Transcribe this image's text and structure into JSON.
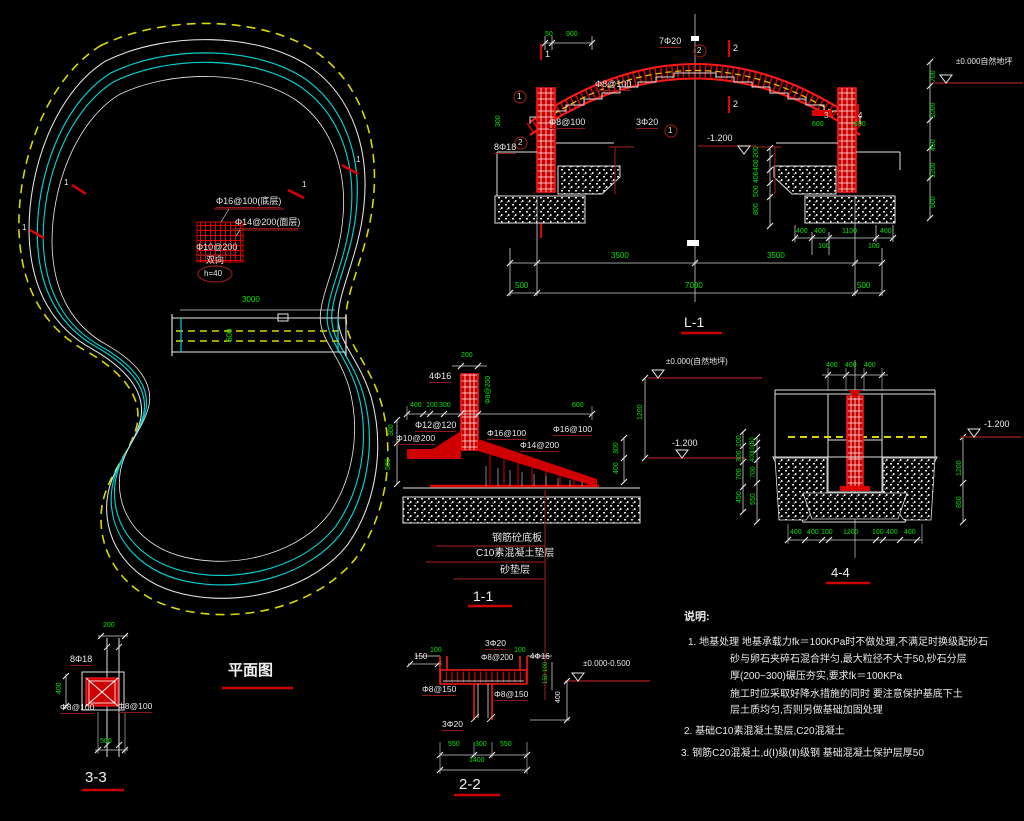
{
  "plan": {
    "title": "平面图"
  },
  "sections": {
    "l1": {
      "title": "L-1"
    },
    "s11": {
      "title": "1-1"
    },
    "s22": {
      "title": "2-2"
    },
    "s33": {
      "title": "3-3"
    },
    "s44": {
      "title": "4-4"
    }
  },
  "notes": {
    "title": "说明:",
    "lines": [
      "1. 地基处理 地基承载力fk＝100KPa时不做处理,不满足时换级配砂石",
      "砂与卵石夹碎石混合拌匀,最大粒径不大于50,砂石分层",
      "厚(200~300)碾压夯实,要求fk＝100KPa",
      "施工时应采取好降水措施的同时 要注意保护基底下土",
      "层土质均匀,否则另做基础加固处理",
      "2. 基础C10素混凝土垫层,C20混凝土",
      "3. 钢筋C20混凝土,d(Ⅰ)级(Ⅱ)级钢 基础混凝土保护层厚50"
    ]
  },
  "colors": {
    "w": "#e8e8e8",
    "g": "#00e400",
    "r": "#ff2a2a",
    "m": "#8b1a1a",
    "y": "#d8d800",
    "c": "#00d2d2"
  },
  "annotations": [
    {
      "n": "plan-rebar-bottom-label",
      "t": "Φ16@100(底层)",
      "x": 216,
      "y": 197,
      "c": "w",
      "s": 9,
      "u": 1
    },
    {
      "n": "plan-rebar-top-label",
      "t": "Φ14@200(面层)",
      "x": 235,
      "y": 218,
      "c": "w",
      "s": 9,
      "u": 1
    },
    {
      "n": "plan-rebar-dist-label",
      "t": "Φ10@200",
      "x": 196,
      "y": 243,
      "c": "w",
      "s": 9
    },
    {
      "n": "plan-both-ways-label",
      "t": "双向",
      "x": 206,
      "y": 256,
      "c": "w",
      "s": 9
    },
    {
      "n": "plan-thickness-label",
      "t": "h=40",
      "x": 204,
      "y": 270,
      "c": "w",
      "s": 8
    },
    {
      "n": "plan-dim",
      "t": "3000",
      "x": 242,
      "y": 296,
      "c": "g",
      "s": 8
    },
    {
      "n": "plan-dim",
      "t": "600",
      "x": 226,
      "y": 342,
      "c": "g",
      "s": 8,
      "r90": 1
    },
    {
      "n": "section-mark",
      "t": "1",
      "x": 356,
      "y": 156,
      "c": "w",
      "s": 8
    },
    {
      "n": "section-mark",
      "t": "1",
      "x": 302,
      "y": 181,
      "c": "w",
      "s": 8
    },
    {
      "n": "section-mark",
      "t": "1",
      "x": 64,
      "y": 179,
      "c": "w",
      "s": 8
    },
    {
      "n": "section-mark",
      "t": "1",
      "x": 22,
      "y": 224,
      "c": "w",
      "s": 8
    },
    {
      "n": "dim",
      "t": "50",
      "x": 545,
      "y": 31,
      "c": "g",
      "s": 7
    },
    {
      "n": "dim",
      "t": "900",
      "x": 566,
      "y": 31,
      "c": "g",
      "s": 7
    },
    {
      "n": "rebar-label",
      "t": "7Φ20",
      "x": 659,
      "y": 37,
      "c": "w",
      "s": 9,
      "u": 1
    },
    {
      "n": "bubble-no",
      "t": "2",
      "x": 697,
      "y": 47,
      "c": "w",
      "s": 8
    },
    {
      "n": "bubble-no",
      "t": "1",
      "x": 517,
      "y": 93,
      "c": "w",
      "s": 8
    },
    {
      "n": "bubble-no",
      "t": "2",
      "x": 518,
      "y": 139,
      "c": "w",
      "s": 8
    },
    {
      "n": "bubble-no",
      "t": "1",
      "x": 668,
      "y": 127,
      "c": "w",
      "s": 8
    },
    {
      "n": "rebar-label",
      "t": "Φ8@100",
      "x": 595,
      "y": 80,
      "c": "w",
      "s": 9,
      "u": 1
    },
    {
      "n": "rebar-label",
      "t": "3Φ20",
      "x": 636,
      "y": 118,
      "c": "w",
      "s": 9,
      "u": 1
    },
    {
      "n": "rebar-label",
      "t": "Φ8@100",
      "x": 549,
      "y": 118,
      "c": "w",
      "s": 9,
      "u": 1
    },
    {
      "n": "rebar-label",
      "t": "8Φ18",
      "x": 494,
      "y": 143,
      "c": "w",
      "s": 9,
      "u": 1
    },
    {
      "n": "dim",
      "t": "300",
      "x": 495,
      "y": 127,
      "c": "g",
      "s": 7,
      "r90": 1
    },
    {
      "n": "cut-label",
      "t": "2",
      "x": 733,
      "y": 44,
      "c": "w",
      "s": 9
    },
    {
      "n": "cut-label",
      "t": "2",
      "x": 733,
      "y": 100,
      "c": "w",
      "s": 9
    },
    {
      "n": "cut-label",
      "t": "1",
      "x": 545,
      "y": 50,
      "c": "w",
      "s": 9
    },
    {
      "n": "level-label",
      "t": "-1.200",
      "x": 707,
      "y": 134,
      "c": "w",
      "s": 9
    },
    {
      "n": "dim",
      "t": "200",
      "x": 753,
      "y": 158,
      "c": "g",
      "s": 7,
      "r90": 1
    },
    {
      "n": "dim",
      "t": "400",
      "x": 753,
      "y": 171,
      "c": "g",
      "s": 7,
      "r90": 1
    },
    {
      "n": "dim",
      "t": "400",
      "x": 753,
      "y": 183,
      "c": "g",
      "s": 7,
      "r90": 1
    },
    {
      "n": "dim",
      "t": "500",
      "x": 753,
      "y": 197,
      "c": "g",
      "s": 7,
      "r90": 1
    },
    {
      "n": "dim",
      "t": "800",
      "x": 753,
      "y": 215,
      "c": "g",
      "s": 7,
      "r90": 1
    },
    {
      "n": "cut-label",
      "t": "3",
      "x": 824,
      "y": 112,
      "c": "w",
      "s": 8
    },
    {
      "n": "cut-label",
      "t": "4",
      "x": 858,
      "y": 112,
      "c": "w",
      "s": 8
    },
    {
      "n": "dim",
      "t": "600",
      "x": 812,
      "y": 121,
      "c": "g",
      "s": 7
    },
    {
      "n": "dim",
      "t": "600",
      "x": 854,
      "y": 121,
      "c": "g",
      "s": 7
    },
    {
      "n": "dim",
      "t": "700",
      "x": 930,
      "y": 82,
      "c": "g",
      "s": 7,
      "r90": 1
    },
    {
      "n": "dim",
      "t": "1000",
      "x": 930,
      "y": 118,
      "c": "g",
      "s": 7,
      "r90": 1
    },
    {
      "n": "dim",
      "t": "450",
      "x": 930,
      "y": 151,
      "c": "g",
      "s": 7,
      "r90": 1
    },
    {
      "n": "dim",
      "t": "1200",
      "x": 930,
      "y": 178,
      "c": "g",
      "s": 7,
      "r90": 1
    },
    {
      "n": "dim",
      "t": "500",
      "x": 930,
      "y": 208,
      "c": "g",
      "s": 7,
      "r90": 1
    },
    {
      "n": "level-label",
      "t": "±0.000自然地坪",
      "x": 956,
      "y": 58,
      "c": "w",
      "s": 8
    },
    {
      "n": "dim",
      "t": "400",
      "x": 796,
      "y": 228,
      "c": "g",
      "s": 7
    },
    {
      "n": "dim",
      "t": "400",
      "x": 814,
      "y": 228,
      "c": "g",
      "s": 7
    },
    {
      "n": "dim",
      "t": "1100",
      "x": 842,
      "y": 228,
      "c": "g",
      "s": 7
    },
    {
      "n": "dim",
      "t": "400",
      "x": 880,
      "y": 228,
      "c": "g",
      "s": 7
    },
    {
      "n": "dim",
      "t": "100",
      "x": 818,
      "y": 243,
      "c": "g",
      "s": 7
    },
    {
      "n": "dim",
      "t": "100",
      "x": 868,
      "y": 243,
      "c": "g",
      "s": 7
    },
    {
      "n": "dim",
      "t": "3500",
      "x": 611,
      "y": 252,
      "c": "g",
      "s": 8
    },
    {
      "n": "dim",
      "t": "3500",
      "x": 767,
      "y": 252,
      "c": "g",
      "s": 8
    },
    {
      "n": "dim",
      "t": "500",
      "x": 515,
      "y": 282,
      "c": "g",
      "s": 8
    },
    {
      "n": "dim",
      "t": "7000",
      "x": 685,
      "y": 282,
      "c": "g",
      "s": 8
    },
    {
      "n": "dim",
      "t": "500",
      "x": 857,
      "y": 282,
      "c": "g",
      "s": 8
    },
    {
      "n": "dim",
      "t": "200",
      "x": 461,
      "y": 352,
      "c": "g",
      "s": 7
    },
    {
      "n": "rebar-label",
      "t": "4Φ16",
      "x": 429,
      "y": 372,
      "c": "w",
      "s": 9,
      "u": 1
    },
    {
      "n": "rebar-label",
      "t": "Φ8@200",
      "x": 485,
      "y": 404,
      "c": "g",
      "s": 7,
      "r90": 1
    },
    {
      "n": "dim",
      "t": "400",
      "x": 410,
      "y": 402,
      "c": "g",
      "s": 7
    },
    {
      "n": "dim",
      "t": "100",
      "x": 426,
      "y": 402,
      "c": "g",
      "s": 7
    },
    {
      "n": "dim",
      "t": "300",
      "x": 439,
      "y": 402,
      "c": "g",
      "s": 7
    },
    {
      "n": "dim",
      "t": "600",
      "x": 572,
      "y": 402,
      "c": "g",
      "s": 7
    },
    {
      "n": "rebar-label",
      "t": "Φ12@120",
      "x": 415,
      "y": 421,
      "c": "w",
      "s": 9,
      "u": 1
    },
    {
      "n": "rebar-label",
      "t": "Φ10@200",
      "x": 396,
      "y": 434,
      "c": "w",
      "s": 8.5,
      "u": 1
    },
    {
      "n": "rebar-label",
      "t": "Φ16@100",
      "x": 487,
      "y": 429,
      "c": "w",
      "s": 8.5,
      "u": 1
    },
    {
      "n": "rebar-label",
      "t": "Φ14@200",
      "x": 520,
      "y": 441,
      "c": "w",
      "s": 8.5,
      "u": 1
    },
    {
      "n": "rebar-label",
      "t": "Φ16@100",
      "x": 553,
      "y": 425,
      "c": "w",
      "s": 8.5,
      "u": 1
    },
    {
      "n": "dim",
      "t": "300",
      "x": 388,
      "y": 436,
      "c": "g",
      "s": 7,
      "r90": 1
    },
    {
      "n": "dim",
      "t": "500",
      "x": 385,
      "y": 470,
      "c": "g",
      "s": 7,
      "r90": 1
    },
    {
      "n": "level-label",
      "t": "±0.000(自然地坪)",
      "x": 666,
      "y": 358,
      "c": "w",
      "s": 8
    },
    {
      "n": "dim",
      "t": "1200",
      "x": 637,
      "y": 420,
      "c": "g",
      "s": 7,
      "r90": 1
    },
    {
      "n": "level-label",
      "t": "-1.200",
      "x": 672,
      "y": 439,
      "c": "w",
      "s": 9
    },
    {
      "n": "dim",
      "t": "300",
      "x": 613,
      "y": 454,
      "c": "g",
      "s": 7,
      "r90": 1
    },
    {
      "n": "dim",
      "t": "400",
      "x": 613,
      "y": 474,
      "c": "g",
      "s": 7,
      "r90": 1
    },
    {
      "n": "dim",
      "t": "100",
      "x": 736,
      "y": 447,
      "c": "g",
      "s": 7,
      "r90": 1
    },
    {
      "n": "dim",
      "t": "300",
      "x": 736,
      "y": 462,
      "c": "g",
      "s": 7,
      "r90": 1
    },
    {
      "n": "dim",
      "t": "700",
      "x": 736,
      "y": 480,
      "c": "g",
      "s": 7,
      "r90": 1
    },
    {
      "n": "dim",
      "t": "450",
      "x": 736,
      "y": 503,
      "c": "g",
      "s": 7,
      "r90": 1
    },
    {
      "n": "material-label",
      "t": "钢筋砼底板",
      "x": 492,
      "y": 534,
      "c": "w",
      "s": 10
    },
    {
      "n": "material-label",
      "t": "C10素混凝土垫层",
      "x": 476,
      "y": 549,
      "c": "w",
      "s": 10
    },
    {
      "n": "material-label",
      "t": "砂垫层",
      "x": 500,
      "y": 566,
      "c": "w",
      "s": 10
    },
    {
      "n": "dim",
      "t": "400",
      "x": 826,
      "y": 362,
      "c": "g",
      "s": 7
    },
    {
      "n": "dim",
      "t": "400",
      "x": 845,
      "y": 362,
      "c": "g",
      "s": 7
    },
    {
      "n": "dim",
      "t": "400",
      "x": 864,
      "y": 362,
      "c": "g",
      "s": 7
    },
    {
      "n": "level-label",
      "t": "-1.200",
      "x": 984,
      "y": 420,
      "c": "w",
      "s": 9
    },
    {
      "n": "dim",
      "t": "50",
      "x": 750,
      "y": 444,
      "c": "g",
      "s": 6,
      "r90": 1
    },
    {
      "n": "dim",
      "t": "100",
      "x": 750,
      "y": 453,
      "c": "g",
      "s": 6,
      "r90": 1
    },
    {
      "n": "dim",
      "t": "400",
      "x": 750,
      "y": 462,
      "c": "g",
      "s": 6,
      "r90": 1
    },
    {
      "n": "dim",
      "t": "700",
      "x": 750,
      "y": 478,
      "c": "g",
      "s": 7,
      "r90": 1
    },
    {
      "n": "dim",
      "t": "550",
      "x": 750,
      "y": 505,
      "c": "g",
      "s": 7,
      "r90": 1
    },
    {
      "n": "dim",
      "t": "1200",
      "x": 956,
      "y": 476,
      "c": "g",
      "s": 7,
      "r90": 1
    },
    {
      "n": "dim",
      "t": "850",
      "x": 956,
      "y": 508,
      "c": "g",
      "s": 7,
      "r90": 1
    },
    {
      "n": "dim",
      "t": "400",
      "x": 790,
      "y": 529,
      "c": "g",
      "s": 7
    },
    {
      "n": "dim",
      "t": "400",
      "x": 807,
      "y": 529,
      "c": "g",
      "s": 7
    },
    {
      "n": "dim",
      "t": "100",
      "x": 821,
      "y": 529,
      "c": "g",
      "s": 7
    },
    {
      "n": "dim",
      "t": "1200",
      "x": 843,
      "y": 529,
      "c": "g",
      "s": 7
    },
    {
      "n": "dim",
      "t": "100",
      "x": 872,
      "y": 529,
      "c": "g",
      "s": 7
    },
    {
      "n": "dim",
      "t": "400",
      "x": 886,
      "y": 529,
      "c": "g",
      "s": 7
    },
    {
      "n": "dim",
      "t": "400",
      "x": 904,
      "y": 529,
      "c": "g",
      "s": 7
    },
    {
      "n": "dim",
      "t": "200",
      "x": 103,
      "y": 622,
      "c": "g",
      "s": 7
    },
    {
      "n": "rebar-label",
      "t": "8Φ18",
      "x": 70,
      "y": 655,
      "c": "w",
      "s": 9,
      "u": 1
    },
    {
      "n": "dim",
      "t": "400",
      "x": 56,
      "y": 694,
      "c": "g",
      "s": 7,
      "r90": 1
    },
    {
      "n": "rebar-label",
      "t": "Φ8@100",
      "x": 60,
      "y": 703,
      "c": "w",
      "s": 8.5,
      "u": 1
    },
    {
      "n": "rebar-label",
      "t": "Φ8@100",
      "x": 118,
      "y": 702,
      "c": "w",
      "s": 8.5,
      "u": 1
    },
    {
      "n": "dim",
      "t": "500",
      "x": 100,
      "y": 738,
      "c": "g",
      "s": 7
    },
    {
      "n": "rebar-label",
      "t": "3Φ20",
      "x": 485,
      "y": 639,
      "c": "w",
      "s": 8.5,
      "u": 1
    },
    {
      "n": "dim",
      "t": "150",
      "x": 414,
      "y": 653,
      "c": "w",
      "s": 8
    },
    {
      "n": "dim",
      "t": "100",
      "x": 430,
      "y": 647,
      "c": "g",
      "s": 7
    },
    {
      "n": "rebar-label",
      "t": "Φ8@200",
      "x": 481,
      "y": 654,
      "c": "w",
      "s": 8
    },
    {
      "n": "dim",
      "t": "100",
      "x": 514,
      "y": 647,
      "c": "g",
      "s": 7
    },
    {
      "n": "rebar-label",
      "t": "4Φ16",
      "x": 530,
      "y": 653,
      "c": "w",
      "s": 8
    },
    {
      "n": "rebar-label",
      "t": "Φ8@150",
      "x": 422,
      "y": 685,
      "c": "w",
      "s": 8.5,
      "u": 1
    },
    {
      "n": "rebar-label",
      "t": "Φ8@150",
      "x": 494,
      "y": 690,
      "c": "w",
      "s": 8.5,
      "u": 1
    },
    {
      "n": "rebar-label",
      "t": "3Φ20",
      "x": 442,
      "y": 720,
      "c": "w",
      "s": 8.5,
      "u": 1
    },
    {
      "n": "dim",
      "t": "550",
      "x": 448,
      "y": 741,
      "c": "g",
      "s": 7
    },
    {
      "n": "dim",
      "t": "300",
      "x": 475,
      "y": 741,
      "c": "g",
      "s": 7
    },
    {
      "n": "dim",
      "t": "550",
      "x": 500,
      "y": 741,
      "c": "g",
      "s": 7
    },
    {
      "n": "dim",
      "t": "1400",
      "x": 469,
      "y": 757,
      "c": "g",
      "s": 7
    },
    {
      "n": "level-label",
      "t": "±0.000-0.500",
      "x": 583,
      "y": 660,
      "c": "w",
      "s": 8
    },
    {
      "n": "dim",
      "t": "100",
      "x": 543,
      "y": 672,
      "c": "g",
      "s": 6,
      "r90": 1
    },
    {
      "n": "dim",
      "t": "150",
      "x": 543,
      "y": 684,
      "c": "g",
      "s": 6,
      "r90": 1
    },
    {
      "n": "dim",
      "t": "400",
      "x": 555,
      "y": 703,
      "c": "w",
      "s": 7,
      "r90": 1
    }
  ]
}
